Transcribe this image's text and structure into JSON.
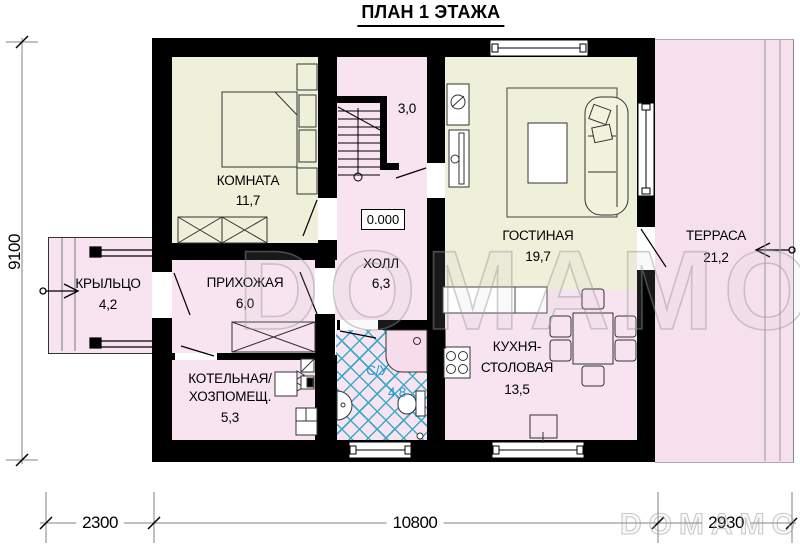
{
  "title": "ПЛАН 1 ЭТАЖА",
  "elevation": "0.000",
  "watermark": "DOMAMO",
  "rooms": {
    "bedroom": {
      "name": "КОМНАТА",
      "area": "11,7"
    },
    "stair": {
      "area": "3,0"
    },
    "hall": {
      "name": "ХОЛЛ",
      "area": "6,3"
    },
    "living": {
      "name": "ГОСТИНАЯ",
      "area": "19,7"
    },
    "terrace": {
      "name": "ТЕРРАСА",
      "area": "21,2"
    },
    "porch": {
      "name": "КРЫЛЬЦО",
      "area": "4,2"
    },
    "entry": {
      "name": "ПРИХОЖАЯ",
      "area": "6,0"
    },
    "boiler": {
      "name_line1": "КОТЕЛЬНАЯ/",
      "name_line2": "ХОЗПОМЕЩ.",
      "area": "5,3"
    },
    "bath": {
      "name": "С/У",
      "area": "4,8"
    },
    "kitchen": {
      "name_line1": "КУХНЯ-",
      "name_line2": "СТОЛОВАЯ",
      "area": "13,5"
    }
  },
  "dimensions": {
    "left": "9100",
    "bottom": [
      "2300",
      "10800",
      "2930"
    ]
  },
  "colors": {
    "wall": "#000000",
    "floor_warm": "#eef0d9",
    "floor_pink": "#f8e3f0",
    "terrace_pink": "#f7e0ee",
    "tile_blue": "#3aacca",
    "bath_label_blue": "#1f9cd6"
  }
}
